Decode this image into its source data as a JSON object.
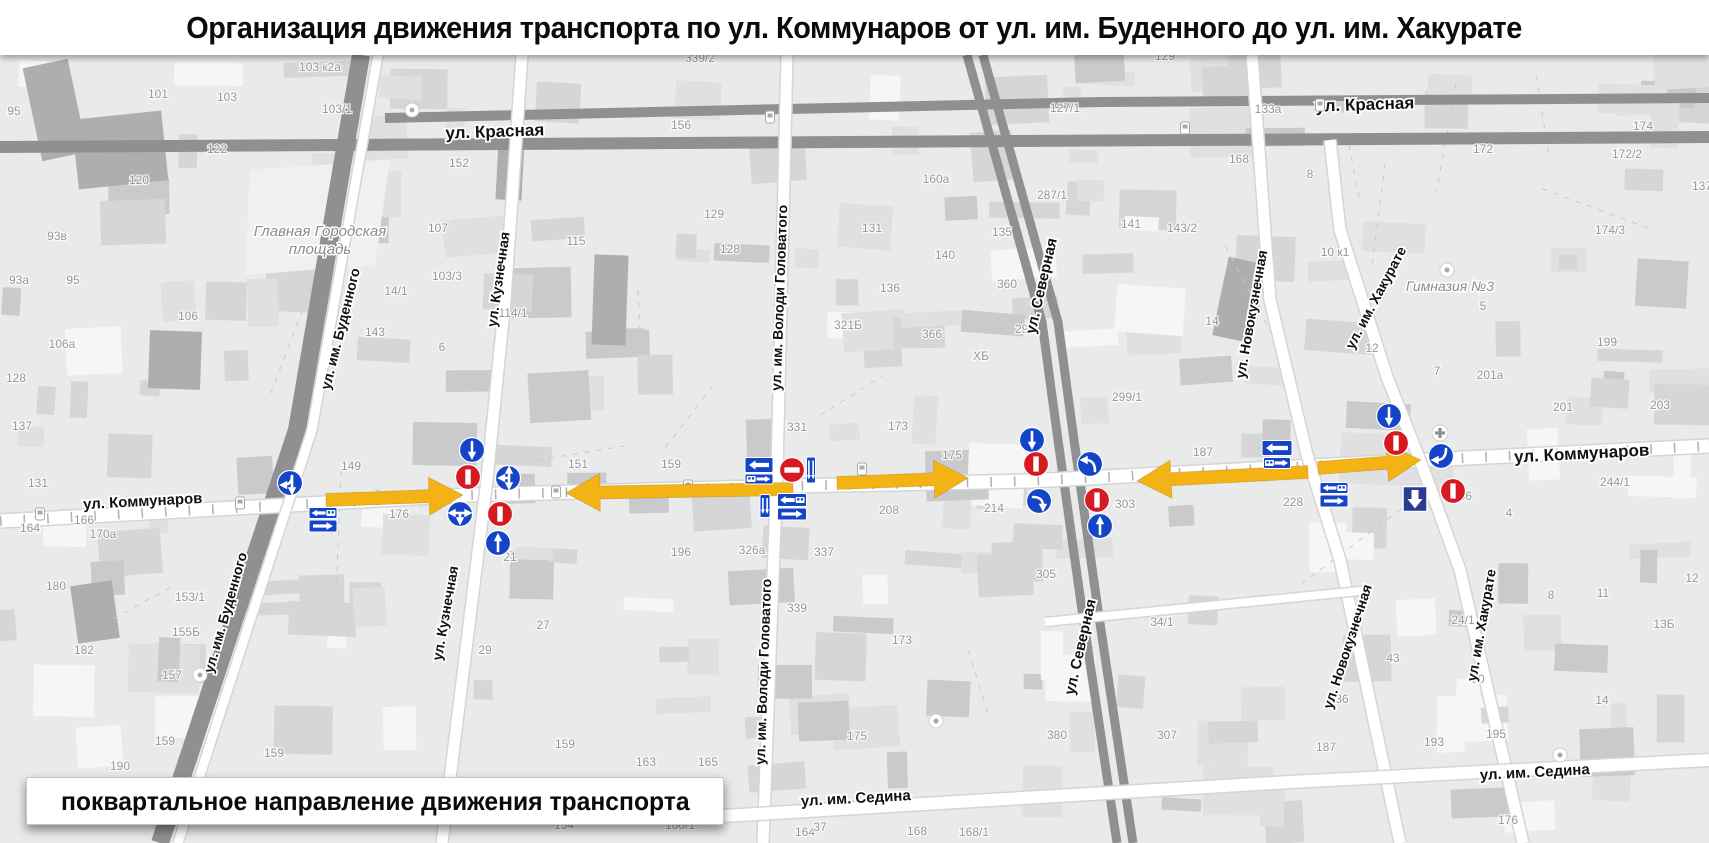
{
  "title": "Организация движения транспорта по ул. Коммунаров от ул. им. Буденного до ул. им. Хакурате",
  "legend": {
    "text": "поквартальное направление движения транспорта"
  },
  "colors": {
    "arrow": "#F4B314",
    "sign_blue": "#1445C6",
    "sign_red": "#D51A21",
    "sign_navy": "#2A3C90",
    "road_dark": "#8F9092",
    "road_casing": "#D5D5D7",
    "map_bg": "#E9EAEA",
    "label": "#111111",
    "muted_label": "#97979A",
    "place_label": "#8C8C8E"
  },
  "map": {
    "street_labels": [
      {
        "t": "ул. Красная",
        "x": 495,
        "y": 137,
        "r": -2,
        "s": 17
      },
      {
        "t": "ул. Красная",
        "x": 1365,
        "y": 110,
        "r": -2,
        "s": 17
      },
      {
        "t": "ул. Коммунаров",
        "x": 143,
        "y": 506,
        "r": -3,
        "s": 15
      },
      {
        "t": "ул. Коммунаров",
        "x": 1582,
        "y": 459,
        "r": -3,
        "s": 17
      },
      {
        "t": "ул. им. Седина",
        "x": 856,
        "y": 803,
        "r": -3,
        "s": 15
      },
      {
        "t": "ул. им. Седина",
        "x": 1535,
        "y": 777,
        "r": -3,
        "s": 15
      },
      {
        "t": "ул. им. Буденного",
        "x": 345,
        "y": 330,
        "r": -76,
        "s": 14
      },
      {
        "t": "ул. им. Буденного",
        "x": 230,
        "y": 614,
        "r": -74,
        "s": 14
      },
      {
        "t": "ул. Кузнечная",
        "x": 503,
        "y": 280,
        "r": -82,
        "s": 14
      },
      {
        "t": "ул. Кузнечная",
        "x": 450,
        "y": 614,
        "r": -80,
        "s": 14
      },
      {
        "t": "ул. им. Володи Головатого",
        "x": 784,
        "y": 298,
        "r": -88,
        "s": 14
      },
      {
        "t": "ул. им. Володи Головатого",
        "x": 768,
        "y": 672,
        "r": -88,
        "s": 14
      },
      {
        "t": "ул. Северная",
        "x": 1046,
        "y": 287,
        "r": -77,
        "s": 15
      },
      {
        "t": "ул. Северная",
        "x": 1085,
        "y": 648,
        "r": -77,
        "s": 15
      },
      {
        "t": "ул. Новокузнечная",
        "x": 1256,
        "y": 315,
        "r": -80,
        "s": 14
      },
      {
        "t": "ул. Новокузнечная",
        "x": 1352,
        "y": 648,
        "r": -72,
        "s": 14
      },
      {
        "t": "ул. им. Хакурате",
        "x": 1380,
        "y": 300,
        "r": -62,
        "s": 14
      },
      {
        "t": "ул. им. Хакурате",
        "x": 1486,
        "y": 626,
        "r": -80,
        "s": 14
      }
    ],
    "place_labels": [
      {
        "t": "Главная Городская\nплощадь",
        "x": 320,
        "y": 236,
        "s": 15
      },
      {
        "t": "Гимназия №3",
        "x": 1450,
        "y": 291,
        "s": 14
      }
    ],
    "building_numbers": [
      [
        "95",
        14,
        115
      ],
      [
        "101",
        158,
        98
      ],
      [
        "103",
        227,
        101
      ],
      [
        "103 к2а",
        320,
        71
      ],
      [
        "103/1",
        337,
        113
      ],
      [
        "122",
        217,
        153
      ],
      [
        "120",
        139,
        184
      ],
      [
        "93в",
        57,
        240
      ],
      [
        "93а",
        19,
        284
      ],
      [
        "95",
        73,
        284
      ],
      [
        "106",
        188,
        320
      ],
      [
        "106а",
        62,
        348
      ],
      [
        "128",
        16,
        382
      ],
      [
        "137",
        22,
        430
      ],
      [
        "131",
        38,
        487
      ],
      [
        "166",
        84,
        524
      ],
      [
        "164",
        30,
        532
      ],
      [
        "170а",
        103,
        538
      ],
      [
        "180",
        56,
        590
      ],
      [
        "153/1",
        190,
        601
      ],
      [
        "155Б",
        186,
        636
      ],
      [
        "182",
        84,
        654
      ],
      [
        "157",
        172,
        679
      ],
      [
        "159",
        165,
        745
      ],
      [
        "190",
        120,
        770
      ],
      [
        "159",
        274,
        757
      ],
      [
        "27",
        543,
        629
      ],
      [
        "29",
        485,
        654
      ],
      [
        "159",
        565,
        748
      ],
      [
        "143",
        375,
        336
      ],
      [
        "6",
        442,
        351
      ],
      [
        "14/1",
        396,
        295
      ],
      [
        "103/3",
        447,
        280
      ],
      [
        "114/1",
        513,
        317
      ],
      [
        "115",
        576,
        245
      ],
      [
        "152",
        459,
        167
      ],
      [
        "107",
        438,
        232
      ],
      [
        "149",
        351,
        470
      ],
      [
        "176",
        399,
        518
      ],
      [
        "21",
        510,
        561
      ],
      [
        "151",
        578,
        468
      ],
      [
        "159",
        671,
        468
      ],
      [
        "156",
        681,
        129
      ],
      [
        "339/2",
        700,
        62
      ],
      [
        "129",
        714,
        218
      ],
      [
        "128",
        730,
        253
      ],
      [
        "131",
        872,
        232
      ],
      [
        "136",
        890,
        292
      ],
      [
        "321Б",
        848,
        329
      ],
      [
        "331",
        797,
        431
      ],
      [
        "173",
        898,
        430
      ],
      [
        "175",
        952,
        459
      ],
      [
        "196",
        681,
        556
      ],
      [
        "326а",
        752,
        554
      ],
      [
        "337",
        824,
        556
      ],
      [
        "339",
        797,
        612
      ],
      [
        "173",
        902,
        644
      ],
      [
        "175",
        857,
        740
      ],
      [
        "208",
        889,
        514
      ],
      [
        "214",
        994,
        512
      ],
      [
        "303",
        1125,
        508
      ],
      [
        "305",
        1046,
        578
      ],
      [
        "299",
        1025,
        333
      ],
      [
        "299/1",
        1127,
        401
      ],
      [
        "ХБ",
        981,
        360
      ],
      [
        "366",
        932,
        338
      ],
      [
        "160а",
        936,
        183
      ],
      [
        "287/1",
        1052,
        199
      ],
      [
        "135",
        1002,
        236
      ],
      [
        "140",
        945,
        259
      ],
      [
        "360",
        1007,
        288
      ],
      [
        "127/1",
        1065,
        112
      ],
      [
        "133а",
        1268,
        113
      ],
      [
        "129",
        1165,
        60
      ],
      [
        "141",
        1131,
        228
      ],
      [
        "143/2",
        1182,
        232
      ],
      [
        "168",
        1239,
        163
      ],
      [
        "8",
        1310,
        178
      ],
      [
        "14",
        1212,
        325
      ],
      [
        "10 к1",
        1335,
        256
      ],
      [
        "187",
        1203,
        456
      ],
      [
        "228",
        1293,
        506
      ],
      [
        "380",
        1057,
        739
      ],
      [
        "307",
        1167,
        739
      ],
      [
        "34/1",
        1162,
        626
      ],
      [
        "172",
        1483,
        153
      ],
      [
        "174",
        1643,
        130
      ],
      [
        "172/2",
        1627,
        158
      ],
      [
        "174/3",
        1610,
        234
      ],
      [
        "137",
        1702,
        190
      ],
      [
        "12",
        1372,
        352
      ],
      [
        "5",
        1483,
        310
      ],
      [
        "7",
        1437,
        375
      ],
      [
        "199",
        1607,
        346
      ],
      [
        "201а",
        1490,
        379
      ],
      [
        "201",
        1563,
        411
      ],
      [
        "203",
        1660,
        409
      ],
      [
        "244/1",
        1615,
        486
      ],
      [
        "236",
        1462,
        500
      ],
      [
        "4",
        1509,
        517
      ],
      [
        "43",
        1393,
        662
      ],
      [
        "30",
        1478,
        683
      ],
      [
        "24/1",
        1463,
        624
      ],
      [
        "36",
        1342,
        703
      ],
      [
        "187",
        1326,
        751
      ],
      [
        "193",
        1434,
        746
      ],
      [
        "195",
        1496,
        738
      ],
      [
        "8",
        1551,
        599
      ],
      [
        "11",
        1603,
        597
      ],
      [
        "12",
        1692,
        582
      ],
      [
        "13Б",
        1664,
        628
      ],
      [
        "14",
        1602,
        704
      ],
      [
        "176",
        1508,
        824
      ],
      [
        "164",
        805,
        836
      ],
      [
        "168",
        917,
        835
      ],
      [
        "168/1",
        974,
        836
      ],
      [
        "154",
        564,
        829
      ],
      [
        "160/1",
        680,
        829
      ],
      [
        "163",
        646,
        766
      ],
      [
        "165",
        708,
        766
      ],
      [
        "37",
        820,
        831
      ]
    ],
    "roads": {
      "dark": [
        {
          "pts": [
            [
              0,
              147
            ],
            [
              1709,
              137
            ]
          ],
          "w": 12
        },
        {
          "pts": [
            [
              385,
              118
            ],
            [
              1100,
              102
            ],
            [
              1709,
              98
            ]
          ],
          "w": 10
        },
        {
          "pts": [
            [
              967,
              55
            ],
            [
              1042,
              322
            ],
            [
              1058,
              440
            ],
            [
              1082,
              610
            ],
            [
              1117,
              843
            ]
          ],
          "w": 9
        },
        {
          "pts": [
            [
              983,
              55
            ],
            [
              1058,
              322
            ],
            [
              1074,
              440
            ],
            [
              1098,
              610
            ],
            [
              1133,
              843
            ]
          ],
          "w": 9
        },
        {
          "pts": [
            [
              361,
              55
            ],
            [
              297,
              430
            ],
            [
              160,
              843
            ]
          ],
          "w": 18
        }
      ],
      "white": [
        {
          "pts": [
            [
              0,
              521
            ],
            [
              470,
              495
            ],
            [
              792,
              486
            ],
            [
              1030,
              481
            ],
            [
              1425,
              460
            ],
            [
              1709,
              446
            ]
          ],
          "w": 13,
          "tram": true
        },
        {
          "pts": [
            [
              522,
              55
            ],
            [
              505,
              300
            ],
            [
              487,
              480
            ],
            [
              442,
              843
            ]
          ],
          "w": 11
        },
        {
          "pts": [
            [
              787,
              55
            ],
            [
              777,
              470
            ],
            [
              763,
              843
            ]
          ],
          "w": 11
        },
        {
          "pts": [
            [
              1252,
              55
            ],
            [
              1270,
              300
            ],
            [
              1307,
              455
            ],
            [
              1340,
              560
            ],
            [
              1400,
              843
            ]
          ],
          "w": 11
        },
        {
          "pts": [
            [
              1330,
              140
            ],
            [
              1340,
              230
            ],
            [
              1387,
              377
            ],
            [
              1423,
              468
            ],
            [
              1460,
              570
            ],
            [
              1523,
              843
            ]
          ],
          "w": 11
        },
        {
          "pts": [
            [
              690,
              818
            ],
            [
              1290,
              782
            ],
            [
              1709,
              760
            ]
          ],
          "w": 12
        },
        {
          "pts": [
            [
              1045,
              622
            ],
            [
              1370,
              590
            ]
          ],
          "w": 8
        },
        {
          "pts": [
            [
              378,
              55
            ],
            [
              312,
              430
            ],
            [
              178,
              843
            ]
          ],
          "w": 9
        }
      ]
    },
    "flow_arrows": [
      {
        "x1": 326,
        "y1": 500,
        "x2": 463,
        "y2": 495
      },
      {
        "x1": 793,
        "y1": 489,
        "x2": 566,
        "y2": 493
      },
      {
        "x1": 837,
        "y1": 483,
        "x2": 968,
        "y2": 478
      },
      {
        "x1": 1308,
        "y1": 472,
        "x2": 1137,
        "y2": 481
      },
      {
        "x1": 1318,
        "y1": 468,
        "x2": 1421,
        "y2": 460
      }
    ],
    "signs": [
      {
        "kind": "mand",
        "glyph": "fork-dl",
        "x": 290,
        "y": 483
      },
      {
        "kind": "lane",
        "glyph": "left-bus",
        "x": 323,
        "y": 513,
        "w": 28,
        "h": 11
      },
      {
        "kind": "lane",
        "glyph": "right",
        "x": 323,
        "y": 526,
        "w": 28,
        "h": 12
      },
      {
        "kind": "mand",
        "glyph": "down",
        "x": 472,
        "y": 450
      },
      {
        "kind": "noentry",
        "o": "v",
        "x": 468,
        "y": 477
      },
      {
        "kind": "mand",
        "glyph": "t-udl",
        "x": 508,
        "y": 478
      },
      {
        "kind": "mand",
        "glyph": "t-lrd",
        "x": 460,
        "y": 514
      },
      {
        "kind": "noentry",
        "o": "v",
        "x": 500,
        "y": 514
      },
      {
        "kind": "mand",
        "glyph": "up",
        "x": 498,
        "y": 543
      },
      {
        "kind": "lane",
        "glyph": "left",
        "x": 759,
        "y": 465,
        "w": 28,
        "h": 15
      },
      {
        "kind": "lane",
        "glyph": "bus-right",
        "x": 759,
        "y": 479,
        "w": 28,
        "h": 10
      },
      {
        "kind": "noentry",
        "o": "h",
        "x": 792,
        "y": 470
      },
      {
        "kind": "lane",
        "glyph": "vv",
        "x": 811,
        "y": 470,
        "w": 9,
        "h": 26
      },
      {
        "kind": "lane",
        "glyph": "vv",
        "x": 765,
        "y": 506,
        "w": 10,
        "h": 23
      },
      {
        "kind": "lane",
        "glyph": "left-bus",
        "x": 792,
        "y": 500,
        "w": 29,
        "h": 13
      },
      {
        "kind": "lane",
        "glyph": "right",
        "x": 792,
        "y": 514,
        "w": 29,
        "h": 12
      },
      {
        "kind": "mand",
        "glyph": "down",
        "x": 1032,
        "y": 440
      },
      {
        "kind": "noentry",
        "o": "v",
        "x": 1036,
        "y": 464
      },
      {
        "kind": "mand",
        "glyph": "curve-ul",
        "x": 1090,
        "y": 464
      },
      {
        "kind": "mand",
        "glyph": "curve-rd",
        "x": 1039,
        "y": 501
      },
      {
        "kind": "noentry",
        "o": "v",
        "x": 1097,
        "y": 500
      },
      {
        "kind": "mand",
        "glyph": "up",
        "x": 1100,
        "y": 526
      },
      {
        "kind": "lane",
        "glyph": "left",
        "x": 1277,
        "y": 448,
        "w": 30,
        "h": 15
      },
      {
        "kind": "lane",
        "glyph": "bus-right",
        "x": 1277,
        "y": 463,
        "w": 27,
        "h": 11
      },
      {
        "kind": "mand",
        "glyph": "down",
        "x": 1389,
        "y": 416
      },
      {
        "kind": "noentry",
        "o": "v",
        "x": 1396,
        "y": 443
      },
      {
        "kind": "mand",
        "glyph": "hook-left",
        "x": 1441,
        "y": 456
      },
      {
        "kind": "lane",
        "glyph": "left-bus",
        "x": 1334,
        "y": 488,
        "w": 28,
        "h": 11
      },
      {
        "kind": "lane",
        "glyph": "right",
        "x": 1334,
        "y": 501,
        "w": 28,
        "h": 12
      },
      {
        "kind": "oneway",
        "x": 1415,
        "y": 499,
        "w": 24,
        "h": 25
      },
      {
        "kind": "noentry",
        "o": "v",
        "x": 1453,
        "y": 491
      }
    ],
    "poi": [
      {
        "k": "med",
        "x": 1440,
        "y": 433
      },
      {
        "k": "dot",
        "x": 1447,
        "y": 270
      },
      {
        "k": "dot",
        "x": 936,
        "y": 721
      },
      {
        "k": "dot",
        "x": 1560,
        "y": 755
      },
      {
        "k": "dot",
        "x": 412,
        "y": 110
      },
      {
        "k": "dot",
        "x": 200,
        "y": 675
      },
      {
        "k": "bus",
        "x": 40,
        "y": 514
      },
      {
        "k": "bus",
        "x": 240,
        "y": 503
      },
      {
        "k": "bus",
        "x": 556,
        "y": 492
      },
      {
        "k": "bus",
        "x": 862,
        "y": 469
      },
      {
        "k": "bus",
        "x": 688,
        "y": 486
      },
      {
        "k": "bus",
        "x": 1185,
        "y": 128
      },
      {
        "k": "bus",
        "x": 770,
        "y": 117
      },
      {
        "k": "bus",
        "x": 1320,
        "y": 105
      }
    ]
  }
}
